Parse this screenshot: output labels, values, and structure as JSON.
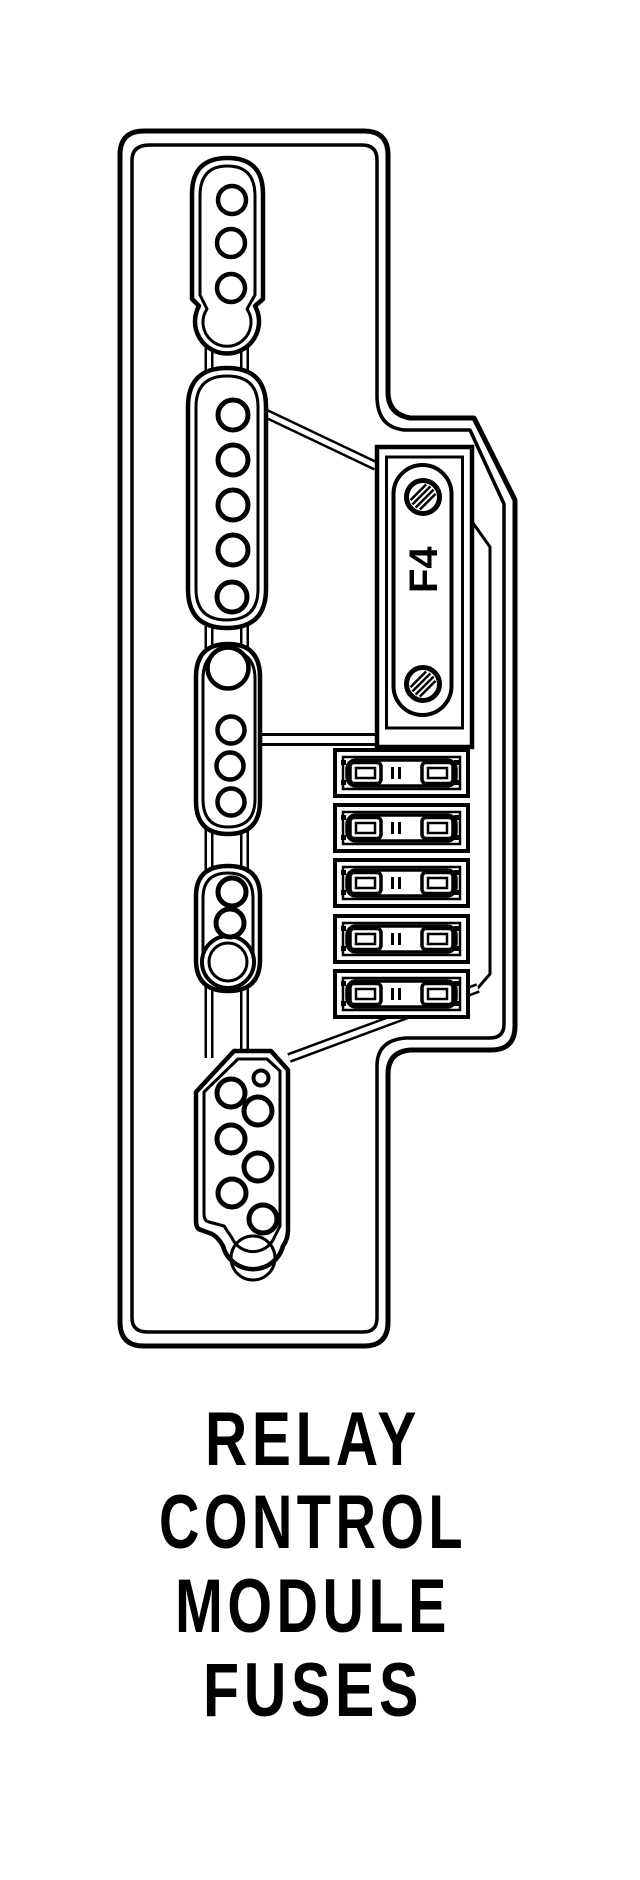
{
  "diagram": {
    "fuse_label": "F4",
    "fuse_slot_count": 5,
    "caption_lines": [
      "RELAY",
      "CONTROL",
      "MODULE",
      "FUSES"
    ],
    "colors": {
      "line": "#000000",
      "background": "#ffffff"
    }
  }
}
